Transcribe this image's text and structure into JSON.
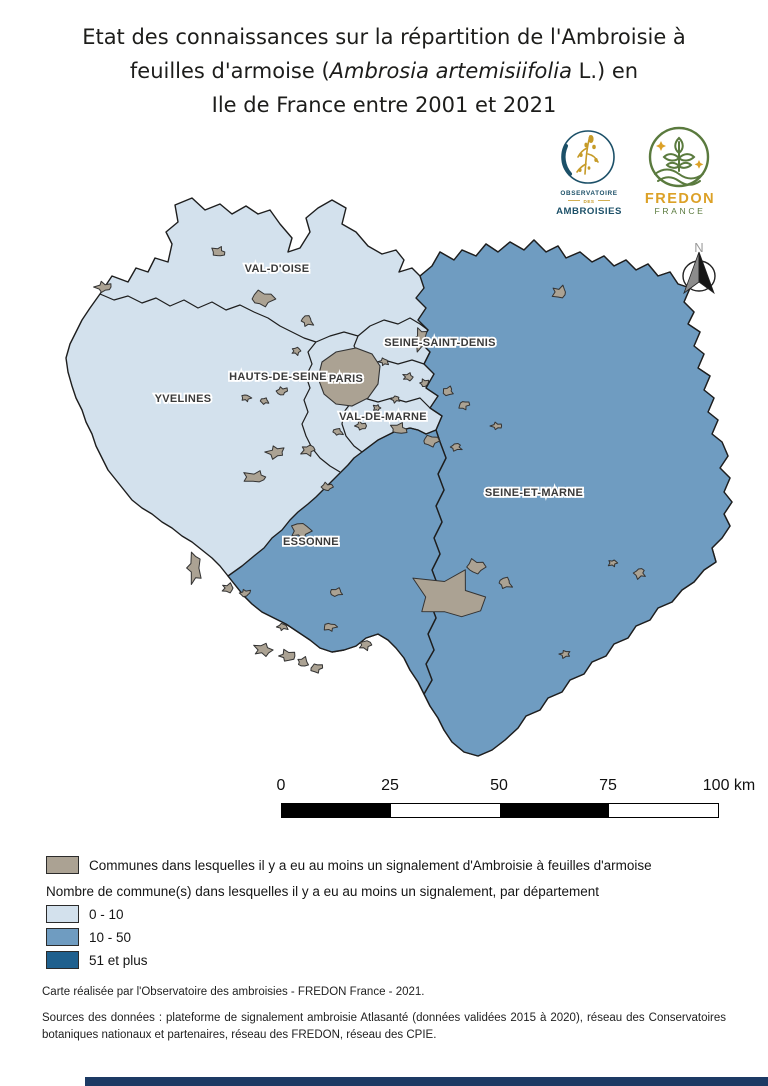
{
  "title": {
    "line1": "Etat des connaissances sur la répartition de l'Ambroisie à",
    "line2_pre": "feuilles d'armoise (",
    "line2_italic": "Ambrosia artemisiifolia",
    "line2_post": " L.) en",
    "line3": "Ile de France entre 2001 et 2021"
  },
  "logos": {
    "observatoire": {
      "line1": "OBSERVATOIRE",
      "line2": "DES",
      "line3": "AMBROISIES",
      "blue": "#1c5068",
      "gold": "#c69b28"
    },
    "fredon": {
      "line1": "FREDON",
      "line2": "FRANCE",
      "green": "#5a7a3e",
      "gold": "#dca127"
    }
  },
  "map": {
    "north_label": "N",
    "colors": {
      "class_0_10": "#d3e1ed",
      "class_10_50": "#6f9cc1",
      "class_51_plus": "#1f608e",
      "commune": "#aba293",
      "outline": "#1e1e1e",
      "commune_outline": "#333333"
    },
    "labels": [
      {
        "text": "VAL-D'OISE",
        "x": 277,
        "y": 272,
        "class": "0 - 10"
      },
      {
        "text": "SEINE-SAINT-DENIS",
        "x": 440,
        "y": 346,
        "class": "0 - 10"
      },
      {
        "text": "HAUTS-DE-SEINE",
        "x": 278,
        "y": 380,
        "class": "0 - 10"
      },
      {
        "text": "PARIS",
        "x": 346,
        "y": 382,
        "class": "0 - 10"
      },
      {
        "text": "VAL-DE-MARNE",
        "x": 383,
        "y": 420,
        "class": "0 - 10"
      },
      {
        "text": "YVELINES",
        "x": 183,
        "y": 402,
        "class": "0 - 10"
      },
      {
        "text": "ESSONNE",
        "x": 311,
        "y": 545,
        "class": "10 - 50"
      },
      {
        "text": "SEINE-ET-MARNE",
        "x": 534,
        "y": 496,
        "class": "10 - 50"
      }
    ],
    "communes": [
      [
        104,
        287,
        9,
        6
      ],
      [
        219,
        252,
        8,
        6
      ],
      [
        262,
        299,
        12,
        9
      ],
      [
        307,
        321,
        7,
        6
      ],
      [
        296,
        351,
        5,
        4
      ],
      [
        420,
        339,
        8,
        12
      ],
      [
        560,
        292,
        9,
        7
      ],
      [
        282,
        391,
        6,
        5
      ],
      [
        265,
        401,
        5,
        4
      ],
      [
        246,
        398,
        5,
        4
      ],
      [
        384,
        362,
        5,
        4
      ],
      [
        408,
        377,
        6,
        4
      ],
      [
        424,
        383,
        5,
        4
      ],
      [
        448,
        391,
        7,
        5
      ],
      [
        464,
        405,
        6,
        5
      ],
      [
        396,
        399,
        5,
        4
      ],
      [
        377,
        408,
        4,
        4
      ],
      [
        361,
        426,
        6,
        5
      ],
      [
        399,
        429,
        10,
        6
      ],
      [
        430,
        441,
        9,
        6
      ],
      [
        456,
        447,
        7,
        4
      ],
      [
        308,
        450,
        8,
        6
      ],
      [
        276,
        452,
        10,
        7
      ],
      [
        256,
        477,
        14,
        7
      ],
      [
        327,
        487,
        6,
        5
      ],
      [
        338,
        432,
        6,
        4
      ],
      [
        300,
        531,
        11,
        9
      ],
      [
        194,
        568,
        8,
        16
      ],
      [
        228,
        588,
        7,
        5
      ],
      [
        245,
        593,
        6,
        4
      ],
      [
        337,
        592,
        8,
        5
      ],
      [
        330,
        627,
        7,
        5
      ],
      [
        283,
        627,
        6,
        4
      ],
      [
        263,
        650,
        10,
        7
      ],
      [
        287,
        656,
        9,
        6
      ],
      [
        303,
        662,
        7,
        5
      ],
      [
        316,
        668,
        7,
        5
      ],
      [
        640,
        573,
        7,
        6
      ],
      [
        613,
        563,
        5,
        4
      ],
      [
        497,
        426,
        6,
        4
      ],
      [
        452,
        597,
        42,
        28
      ],
      [
        475,
        567,
        10,
        8
      ],
      [
        505,
        583,
        8,
        6
      ],
      [
        365,
        645,
        7,
        5
      ],
      [
        565,
        654,
        6,
        4
      ]
    ]
  },
  "scalebar": {
    "ticks": [
      {
        "label": "0",
        "x": 281
      },
      {
        "label": "25",
        "x": 390
      },
      {
        "label": "50",
        "x": 499
      },
      {
        "label": "75",
        "x": 608
      },
      {
        "label": "100 km",
        "x": 729
      }
    ]
  },
  "legend": {
    "communes_label": "Communes dans lesquelles il y a eu au moins un signalement d'Ambroisie à feuilles d'armoise",
    "heading": "Nombre de commune(s) dans lesquelles il y a eu au moins un signalement, par département",
    "classes": [
      {
        "label": "0 - 10",
        "color": "#d3e1ed"
      },
      {
        "label": "10 - 50",
        "color": "#6f9cc1"
      },
      {
        "label": "51 et plus",
        "color": "#1f608e"
      }
    ]
  },
  "footer": {
    "credit": "Carte réalisée par l'Observatoire des ambroisies - FREDON France - 2021.",
    "sources": "Sources des données : plateforme de signalement ambroisie Atlasanté (données validées 2015 à 2020), réseau des Conservatoires botaniques nationaux et partenaires, réseau des FREDON, réseau des CPIE.",
    "bar_color": "#1c3a64"
  }
}
